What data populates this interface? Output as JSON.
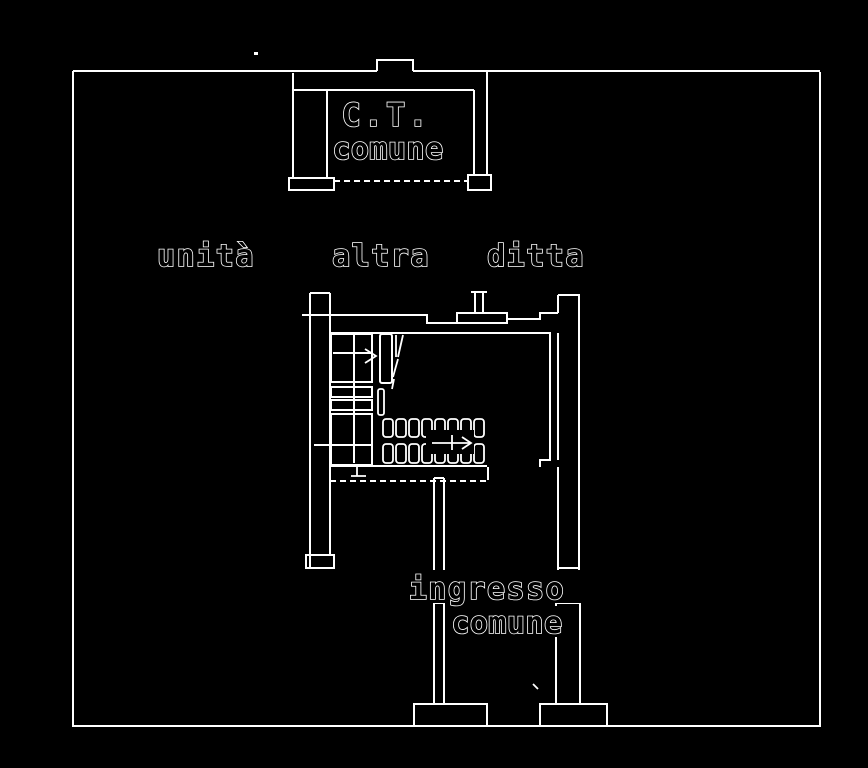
{
  "theme": {
    "background": "#000000",
    "line": "#ffffff"
  },
  "labels": {
    "ct_room": {
      "line1": "C.T.",
      "line2": "comune"
    },
    "ownership": {
      "word1": "unità",
      "word2": "altra",
      "word3": "ditta"
    },
    "entrance": {
      "line1": "ingresso",
      "line2": "comune"
    }
  }
}
